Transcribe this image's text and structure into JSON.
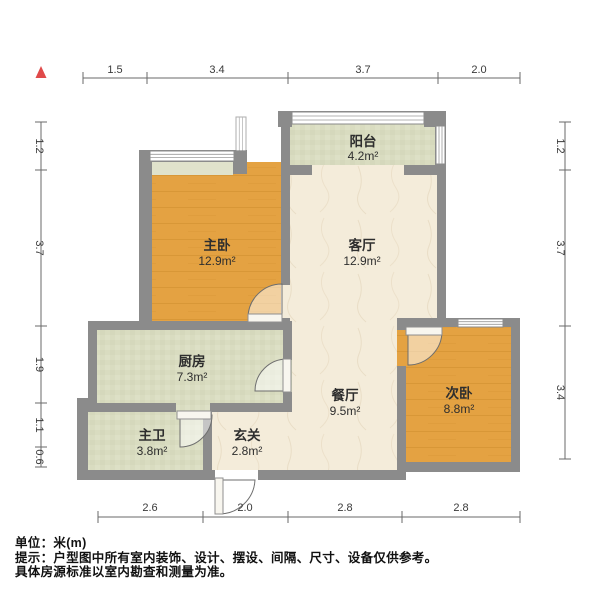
{
  "rooms": {
    "balcony": {
      "name": "阳台",
      "area": "4.2m²"
    },
    "master_bedroom": {
      "name": "主卧",
      "area": "12.9m²"
    },
    "living_room": {
      "name": "客厅",
      "area": "12.9m²"
    },
    "kitchen": {
      "name": "厨房",
      "area": "7.3m²"
    },
    "dining_room": {
      "name": "餐厅",
      "area": "9.5m²"
    },
    "second_bedroom": {
      "name": "次卧",
      "area": "8.8m²"
    },
    "master_bathroom": {
      "name": "主卫",
      "area": "3.8m²"
    },
    "entrance_hall": {
      "name": "玄关",
      "area": "2.8m²"
    }
  },
  "dimensions": {
    "top": [
      "1.5",
      "3.4",
      "3.7",
      "2.0"
    ],
    "left": [
      "1.2",
      "3.7",
      "1.9",
      "1.1",
      "0.6"
    ],
    "right": [
      "1.2",
      "3.7",
      "3.4"
    ],
    "bottom": [
      "2.6",
      "2.0",
      "2.8",
      "2.8"
    ]
  },
  "footer": {
    "unit_label": "单位：米(m)",
    "note_line1": "提示：户型图中所有室内装饰、设计、摆设、间隔、尺寸、设备仅供参考。",
    "note_line2": "具体房源标准以室内勘查和测量为准。"
  },
  "colors": {
    "wall": "#8b8b8b",
    "wood_floor": "#e4a242",
    "marble_floor": "#f4ecda",
    "tile_floor": "#d9dcc0",
    "north_arrow_red": "#e04a4a"
  }
}
